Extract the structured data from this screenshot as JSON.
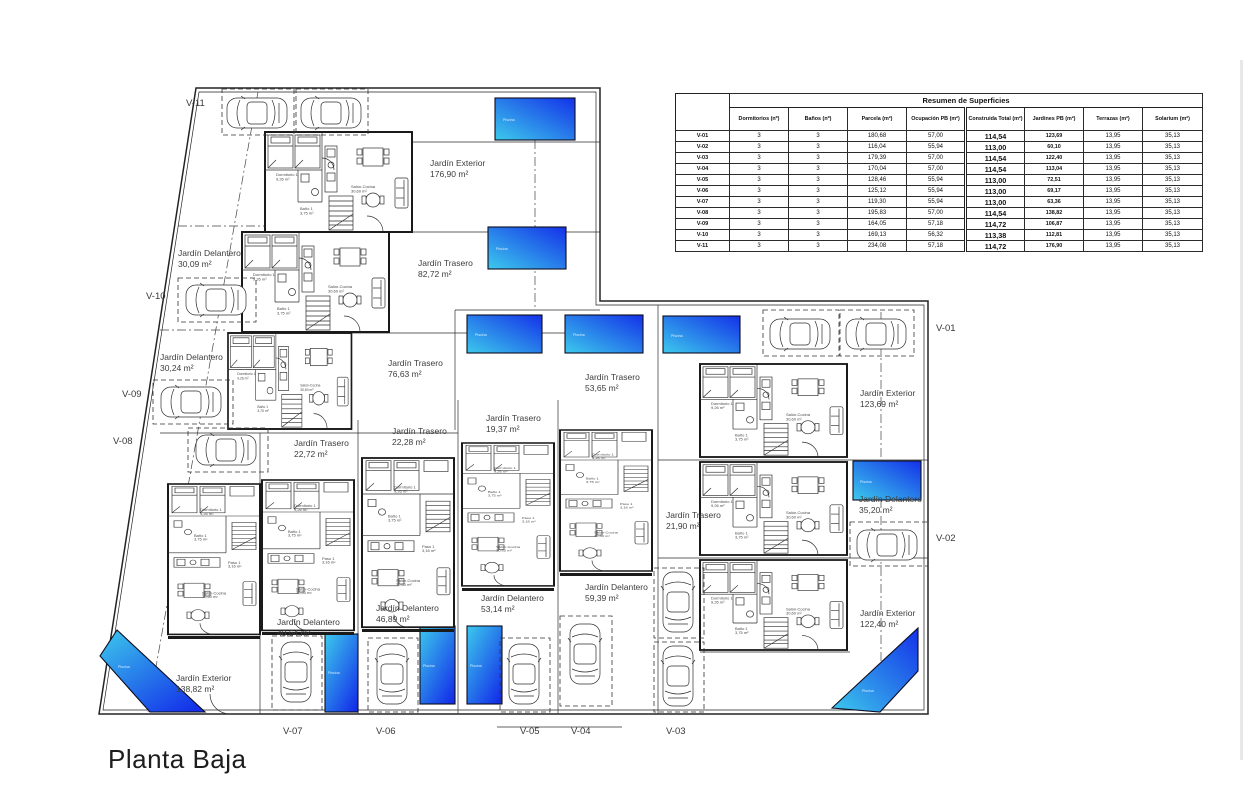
{
  "page_title": "Planta Baja",
  "table": {
    "title": "Resumen de Superficies",
    "columns": [
      "Dormitorios (nº)",
      "Baños (nº)",
      "Parcela (m²)",
      "Ocupación PB (m²)",
      "Construida Total (m²)",
      "Jardines PB (m²)",
      "Terrazas (m²)",
      "Solarium (m²)"
    ],
    "rows": [
      [
        "V-01",
        "3",
        "3",
        "180,68",
        "57,00",
        "114,54",
        "123,69",
        "13,95",
        "35,13"
      ],
      [
        "V-02",
        "3",
        "3",
        "116,04",
        "55,94",
        "113,00",
        "60,10",
        "13,95",
        "35,13"
      ],
      [
        "V-03",
        "3",
        "3",
        "179,39",
        "57,00",
        "114,54",
        "122,40",
        "13,95",
        "35,13"
      ],
      [
        "V-04",
        "3",
        "3",
        "170,04",
        "57,00",
        "114,54",
        "113,04",
        "13,95",
        "35,13"
      ],
      [
        "V-05",
        "3",
        "3",
        "128,46",
        "55,94",
        "113,00",
        "72,51",
        "13,95",
        "35,13"
      ],
      [
        "V-06",
        "3",
        "3",
        "125,12",
        "55,94",
        "113,00",
        "69,17",
        "13,95",
        "35,13"
      ],
      [
        "V-07",
        "3",
        "3",
        "119,30",
        "55,94",
        "113,00",
        "63,36",
        "13,95",
        "35,13"
      ],
      [
        "V-08",
        "3",
        "3",
        "195,83",
        "57,00",
        "114,54",
        "138,82",
        "13,95",
        "35,13"
      ],
      [
        "V-09",
        "3",
        "3",
        "164,05",
        "57,18",
        "114,72",
        "106,87",
        "13,95",
        "35,13"
      ],
      [
        "V-10",
        "3",
        "3",
        "169,13",
        "56,32",
        "113,38",
        "112,81",
        "13,95",
        "35,13"
      ],
      [
        "V-11",
        "3",
        "3",
        "234,08",
        "57,18",
        "114,72",
        "176,90",
        "13,95",
        "35,13"
      ]
    ]
  },
  "units": {
    "v01": "V-01",
    "v02": "V-02",
    "v03": "V-03",
    "v04": "V-04",
    "v05": "V-05",
    "v06": "V-06",
    "v07": "V-07",
    "v08": "V-08",
    "v09": "V-09",
    "v10": "V-10",
    "v11": "V-11"
  },
  "gardens": [
    {
      "name": "Jardín Exterior",
      "area": "176,90 m²"
    },
    {
      "name": "Jardín Delantero",
      "area": "30,09 m²"
    },
    {
      "name": "Jardín Trasero",
      "area": "82,72 m²"
    },
    {
      "name": "Jardín Delantero",
      "area": "30,24 m²"
    },
    {
      "name": "Jardín Trasero",
      "area": "76,63 m²"
    },
    {
      "name": "Jardín Trasero",
      "area": "53,65 m²"
    },
    {
      "name": "Jardín Trasero",
      "area": "19,37 m²"
    },
    {
      "name": "Jardín Trasero",
      "area": "22,28 m²"
    },
    {
      "name": "Jardín Trasero",
      "area": "22,72 m²"
    },
    {
      "name": "Jardín Exterior",
      "area": "123,69 m²"
    },
    {
      "name": "Jardín Trasero",
      "area": "21,90 m²"
    },
    {
      "name": "Jardín Delantero",
      "area": "35,20 m²"
    },
    {
      "name": "Jardín Delantero",
      "area": "59,39 m²"
    },
    {
      "name": "Jardín Delantero",
      "area": "53,14 m²"
    },
    {
      "name": "Jardín Delantero",
      "area": "46,89 m²"
    },
    {
      "name": "Jardín Delantero",
      "area": "40,64 m²"
    },
    {
      "name": "Jardín Exterior",
      "area": "138,82 m²"
    },
    {
      "name": "Jardín Exterior",
      "area": "122,40 m²"
    }
  ],
  "pool_label": "Piscina",
  "rooms": {
    "bedroom": "Dormitorio 1",
    "bedroom_area": "9,26 m²",
    "living": "Salón-Cocina",
    "living_area": "30,60 m²",
    "bath": "Baño 1",
    "bath_area": "3,75 m²",
    "hall": "Paso 1",
    "hall_area": "3,16 m²"
  },
  "colors": {
    "pool_light": "#3cc9ec",
    "pool_dark": "#1431e9",
    "line": "#2b2b2b"
  }
}
